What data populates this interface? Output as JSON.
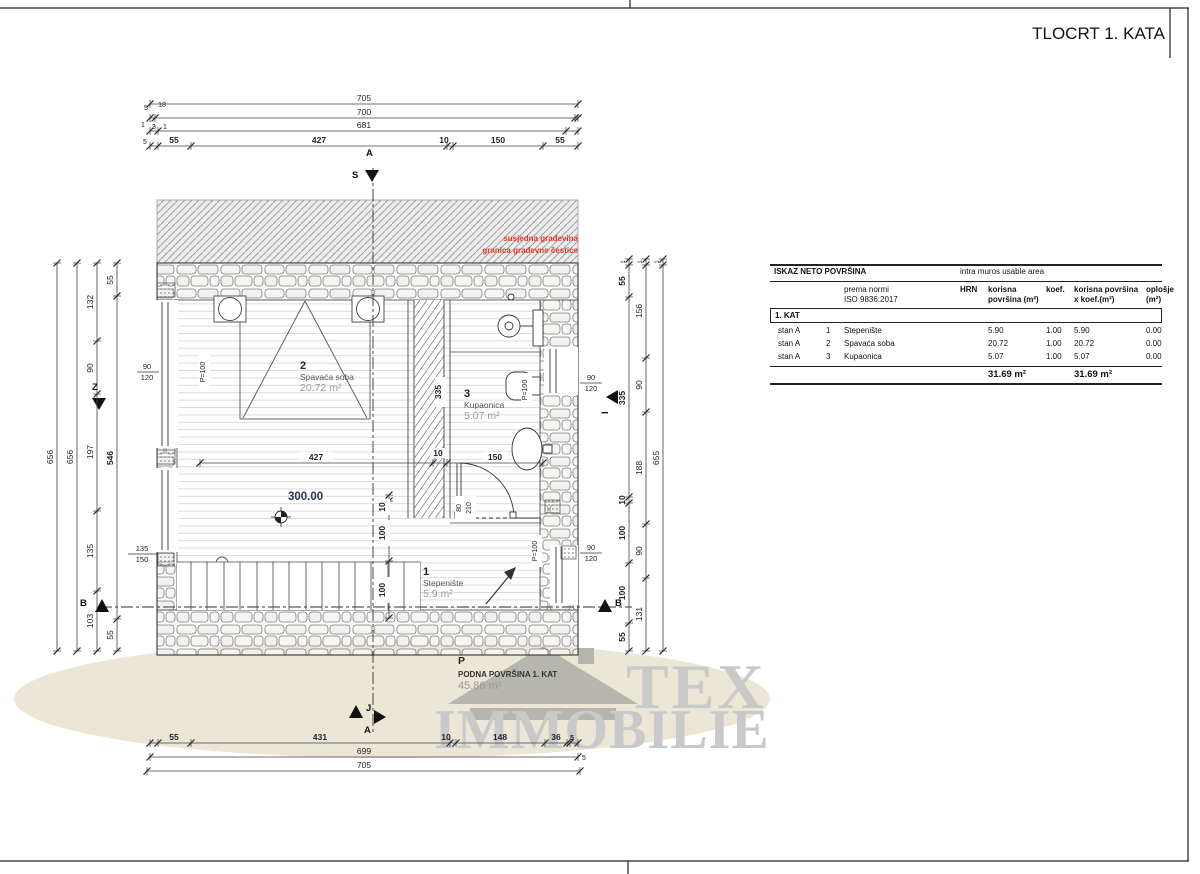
{
  "title": "TLOCRT 1. KATA",
  "watermark": {
    "line1": "TEX",
    "line2": "IMMOBILIE"
  },
  "table": {
    "title_left": "ISKAZ NETO POVRŠINA",
    "title_right": "intra muros usable area",
    "header": {
      "norm1": "prema normi",
      "norm2": "ISO 9836:2017",
      "hrn": "HRN",
      "c1a": "korisna",
      "c1b": "površina (m²)",
      "koef": "koef.",
      "c2a": "korisna površina",
      "c2b": "x koef.(m²)",
      "c3a": "oplošje",
      "c3b": "(m²)"
    },
    "section": "1. KAT",
    "rows": [
      {
        "unit": "stan A",
        "num": "1",
        "name": "Stepenište",
        "area": "5.90",
        "koef": "1.00",
        "area_koef": "5.90",
        "oplosje": "0.00"
      },
      {
        "unit": "stan A",
        "num": "2",
        "name": "Spavaća soba",
        "area": "20.72",
        "koef": "1.00",
        "area_koef": "20.72",
        "oplosje": "0.00"
      },
      {
        "unit": "stan A",
        "num": "3",
        "name": "Kupaonica",
        "area": "5.07",
        "koef": "1.00",
        "area_koef": "5.07",
        "oplosje": "0.00"
      }
    ],
    "total_area": "31.69 m²",
    "total_area_koef": "31.69 m²"
  },
  "plan": {
    "red_note": {
      "line1": "susjedna građevina",
      "line2": "granica građevne čestice"
    },
    "rooms": {
      "r1": {
        "num": "1",
        "name": "Stepenište",
        "area": "5.9 m²"
      },
      "r2": {
        "num": "2",
        "name": "Spavaća soba",
        "area": "20.72 m²"
      },
      "r3": {
        "num": "3",
        "name": "Kupaonica",
        "area": "5.07 m²"
      }
    },
    "level": "300.00",
    "floor_note": {
      "p": "P",
      "line1": "PODNA POVRŠINA 1. KAT",
      "line2": "45.86 m²"
    },
    "markers": {
      "a_top": "A",
      "s": "S",
      "z": "Z",
      "i": "I",
      "j": "J",
      "a_bottom": "A",
      "b_left": "B",
      "b_right": "B"
    },
    "dim_lines": [
      {
        "o": "h",
        "p": 104,
        "a": 150,
        "b": 578,
        "t": [
          150,
          578
        ]
      },
      {
        "o": "h",
        "p": 118,
        "a": 150,
        "b": 578,
        "t": [
          150,
          155,
          575,
          578
        ]
      },
      {
        "o": "h",
        "p": 131,
        "a": 150,
        "b": 578,
        "t": [
          150,
          158,
          566,
          578
        ]
      },
      {
        "o": "h",
        "p": 146,
        "a": 150,
        "b": 578,
        "t": [
          150,
          158,
          191,
          447,
          453,
          543,
          578
        ]
      },
      {
        "o": "h",
        "p": 743,
        "a": 150,
        "b": 578,
        "t": [
          150,
          158,
          191,
          450,
          456,
          545,
          567,
          570,
          578
        ]
      },
      {
        "o": "h",
        "p": 757,
        "a": 150,
        "b": 578,
        "t": [
          150,
          578
        ]
      },
      {
        "o": "h",
        "p": 771,
        "a": 147,
        "b": 580,
        "t": [
          147,
          580
        ]
      },
      {
        "o": "h",
        "p": 463,
        "a": 200,
        "b": 543,
        "t": [
          200,
          433,
          447,
          543
        ]
      },
      {
        "o": "v",
        "p": 57,
        "a": 263,
        "b": 651,
        "t": [
          263,
          651
        ]
      },
      {
        "o": "v",
        "p": 77,
        "a": 263,
        "b": 651,
        "t": [
          263,
          651
        ]
      },
      {
        "o": "v",
        "p": 97,
        "a": 263,
        "b": 651,
        "t": [
          263,
          341,
          394,
          511,
          591,
          651
        ]
      },
      {
        "o": "v",
        "p": 117,
        "a": 263,
        "b": 651,
        "t": [
          263,
          296,
          619,
          651
        ]
      },
      {
        "o": "v",
        "p": 629,
        "a": 259,
        "b": 651,
        "t": [
          259,
          265,
          297,
          497,
          503,
          563,
          623,
          651
        ]
      },
      {
        "o": "v",
        "p": 646,
        "a": 259,
        "b": 651,
        "t": [
          259,
          265,
          358,
          412,
          524,
          578,
          651
        ]
      },
      {
        "o": "v",
        "p": 663,
        "a": 259,
        "b": 651,
        "t": [
          259,
          265,
          651
        ]
      },
      {
        "o": "v",
        "p": 389,
        "a": 495,
        "b": 618,
        "t": [
          495,
          501,
          561,
          618
        ]
      }
    ],
    "dim_labels": [
      {
        "t": "705",
        "x": 364,
        "y": 101
      },
      {
        "t": "700",
        "x": 364,
        "y": 115
      },
      {
        "t": "681",
        "x": 364,
        "y": 128
      },
      {
        "t": "55",
        "x": 174,
        "y": 143,
        "b": 1
      },
      {
        "t": "427",
        "x": 319,
        "y": 143,
        "b": 1
      },
      {
        "t": "10",
        "x": 444,
        "y": 143,
        "b": 1
      },
      {
        "t": "150",
        "x": 498,
        "y": 143,
        "b": 1
      },
      {
        "t": "55",
        "x": 560,
        "y": 143,
        "b": 1
      },
      {
        "t": "5",
        "x": 146,
        "y": 110,
        "s": 7
      },
      {
        "t": "18",
        "x": 162,
        "y": 107,
        "s": 7
      },
      {
        "t": "1",
        "x": 143,
        "y": 127,
        "s": 7
      },
      {
        "t": "3",
        "x": 154,
        "y": 129,
        "s": 7
      },
      {
        "t": "1",
        "x": 165,
        "y": 129,
        "s": 7
      },
      {
        "t": "5",
        "x": 145,
        "y": 144,
        "s": 7
      },
      {
        "t": "55",
        "x": 174,
        "y": 740,
        "b": 1
      },
      {
        "t": "431",
        "x": 320,
        "y": 740,
        "b": 1
      },
      {
        "t": "10",
        "x": 446,
        "y": 740,
        "b": 1
      },
      {
        "t": "148",
        "x": 500,
        "y": 740,
        "b": 1
      },
      {
        "t": "36",
        "x": 556,
        "y": 740,
        "b": 1
      },
      {
        "t": "5",
        "x": 572,
        "y": 740,
        "b": 1,
        "s": 7
      },
      {
        "t": "699",
        "x": 364,
        "y": 754
      },
      {
        "t": "705",
        "x": 364,
        "y": 768
      },
      {
        "t": "5",
        "x": 584,
        "y": 760,
        "s": 7
      },
      {
        "t": "656",
        "x": 53,
        "y": 457,
        "r": 1
      },
      {
        "t": "656",
        "x": 73,
        "y": 457,
        "r": 1
      },
      {
        "t": "132",
        "x": 93,
        "y": 302,
        "r": 1
      },
      {
        "t": "90",
        "x": 93,
        "y": 368,
        "r": 1
      },
      {
        "t": "197",
        "x": 93,
        "y": 452,
        "r": 1
      },
      {
        "t": "135",
        "x": 93,
        "y": 551,
        "r": 1
      },
      {
        "t": "103",
        "x": 93,
        "y": 621,
        "r": 1
      },
      {
        "t": "55",
        "x": 113,
        "y": 280,
        "r": 1
      },
      {
        "t": "546",
        "x": 113,
        "y": 458,
        "r": 1,
        "b": 1
      },
      {
        "t": "55",
        "x": 113,
        "y": 635,
        "r": 1
      },
      {
        "t": "1",
        "x": 625,
        "y": 262,
        "r": 1,
        "s": 6
      },
      {
        "t": "55",
        "x": 625,
        "y": 281,
        "r": 1,
        "b": 1
      },
      {
        "t": "335",
        "x": 625,
        "y": 398,
        "r": 1,
        "b": 1
      },
      {
        "t": "10",
        "x": 625,
        "y": 500,
        "r": 1,
        "b": 1
      },
      {
        "t": "100",
        "x": 625,
        "y": 533,
        "r": 1,
        "b": 1
      },
      {
        "t": "100",
        "x": 625,
        "y": 593,
        "r": 1,
        "b": 1
      },
      {
        "t": "55",
        "x": 625,
        "y": 637,
        "r": 1,
        "b": 1
      },
      {
        "t": "1",
        "x": 642,
        "y": 262,
        "r": 1,
        "s": 6
      },
      {
        "t": "156",
        "x": 642,
        "y": 311,
        "r": 1
      },
      {
        "t": "90",
        "x": 642,
        "y": 385,
        "r": 1
      },
      {
        "t": "188",
        "x": 642,
        "y": 468,
        "r": 1
      },
      {
        "t": "90",
        "x": 642,
        "y": 551,
        "r": 1
      },
      {
        "t": "131",
        "x": 642,
        "y": 614,
        "r": 1
      },
      {
        "t": "1",
        "x": 659,
        "y": 262,
        "r": 1,
        "s": 6
      },
      {
        "t": "655",
        "x": 659,
        "y": 458,
        "r": 1
      },
      {
        "t": "427",
        "x": 316,
        "y": 460,
        "b": 1,
        "w": 34
      },
      {
        "t": "10",
        "x": 438,
        "y": 456,
        "b": 1,
        "w": 16
      },
      {
        "t": "150",
        "x": 495,
        "y": 460,
        "b": 1,
        "w": 24
      },
      {
        "t": "10",
        "x": 385,
        "y": 507,
        "r": 1,
        "b": 1,
        "w": 16
      },
      {
        "t": "100",
        "x": 385,
        "y": 533,
        "r": 1,
        "b": 1,
        "w": 26
      },
      {
        "t": "100",
        "x": 385,
        "y": 590,
        "r": 1,
        "b": 1,
        "w": 26
      },
      {
        "t": "335",
        "x": 441,
        "y": 392,
        "r": 1,
        "b": 1,
        "w": 30
      },
      {
        "t": "90",
        "x": 147,
        "y": 369,
        "s": 7.5
      },
      {
        "t": "120",
        "x": 147,
        "y": 380,
        "s": 7.5
      },
      {
        "t": "135",
        "x": 142,
        "y": 551,
        "s": 7.5
      },
      {
        "t": "150",
        "x": 142,
        "y": 562,
        "s": 7.5
      },
      {
        "t": "90",
        "x": 591,
        "y": 380,
        "s": 7.5
      },
      {
        "t": "120",
        "x": 591,
        "y": 391,
        "s": 7.5
      },
      {
        "t": "90",
        "x": 591,
        "y": 550,
        "s": 7.5
      },
      {
        "t": "120",
        "x": 591,
        "y": 561,
        "s": 7.5
      },
      {
        "t": "P=100",
        "x": 205,
        "y": 372,
        "r": 1,
        "s": 7,
        "w": 38
      },
      {
        "t": "P=100",
        "x": 527,
        "y": 390,
        "r": 1,
        "s": 7,
        "w": 34
      },
      {
        "t": "P=100",
        "x": 537,
        "y": 551,
        "r": 1,
        "s": 7,
        "w": 32
      },
      {
        "t": "80",
        "x": 461,
        "y": 508,
        "r": 1,
        "s": 7,
        "w": 24
      },
      {
        "t": "210",
        "x": 471,
        "y": 508,
        "r": 1,
        "s": 7,
        "w": 24
      }
    ]
  }
}
